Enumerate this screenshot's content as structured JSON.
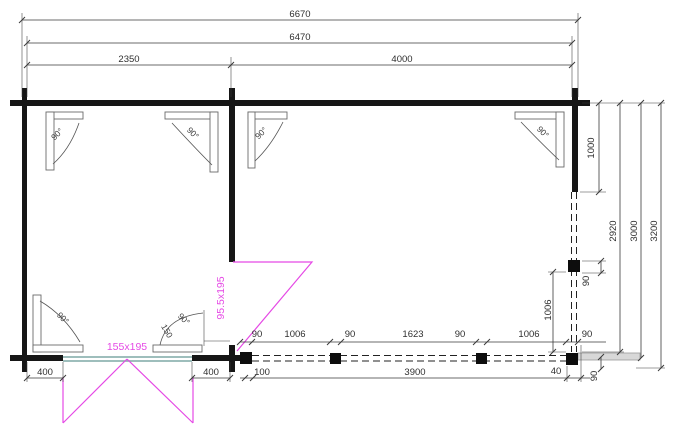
{
  "plan": {
    "dims_top": {
      "overall": "6670",
      "frame": "6470",
      "left_room": "2350",
      "right_room": "4000"
    },
    "dims_right": {
      "wall_segment": "1000",
      "depth_to_posts": "2920",
      "depth_to_edge": "3000",
      "overall_depth": "3200",
      "post_size": "90",
      "post_spacing": "1006",
      "offset_40": "40",
      "offset_90": "90"
    },
    "dims_bottom": {
      "chain": [
        "90",
        "1006",
        "90",
        "1623",
        "90",
        "1006",
        "90"
      ],
      "row2": [
        "100",
        "3900",
        "40"
      ],
      "door_side_left": "400",
      "door_side_right": "400"
    },
    "doors": {
      "double": "155x195",
      "single": "95.5x195"
    },
    "angles": {
      "right_angle": "90°",
      "swing_radius": "150"
    },
    "colors": {
      "wall": "#161616",
      "dimension": "#3a3a3a",
      "door_swing": "#e549e5",
      "threshold": "#7fa8a6",
      "deck_edge": "#d8d8d8"
    }
  }
}
